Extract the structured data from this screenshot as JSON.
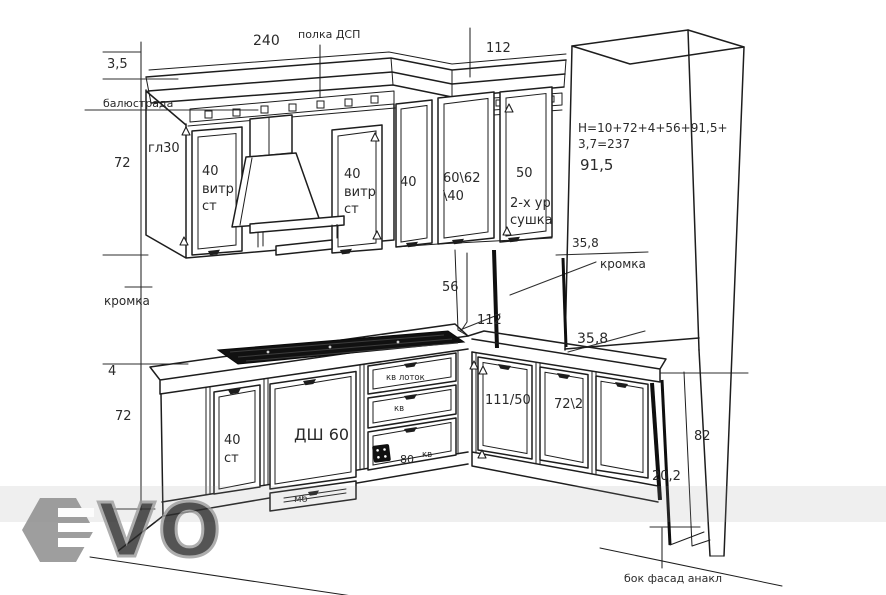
{
  "colors": {
    "ink": "#1d1d1d",
    "dim_ink": "#2e2e2e",
    "edge_dark": "#101010",
    "kromka_text": "#5c5c44",
    "blue_gray": "#44505c",
    "watermark_gray": "#8e8e8e"
  },
  "dims": {
    "total_width": "240",
    "top_depth": "112",
    "cornice_height": "3,5",
    "upper_height": "72",
    "backsplash_height": "56",
    "counter_corner_depth": "112",
    "counter_thickness": "4",
    "base_height": "72",
    "tall_upper_height": "91,5",
    "tall_top_offset": "35,8",
    "tall_bottom_offset": "35,8",
    "right_base_height": "82",
    "right_panel_depth": "20,2",
    "height_formula_line1": "Н=10+72+4+56+91,5+",
    "height_formula_line2": "3,7=237"
  },
  "notes": {
    "shelf": "полка ДСП",
    "balustrade": "балюстрада",
    "depth": "гл30",
    "edge_left": "кромка",
    "edge_right": "кромка",
    "side_facade": "бок фасад анакл"
  },
  "cabinets": {
    "upper_glass_left_line1": "40",
    "upper_glass_left_line2": "витр",
    "upper_glass_left_line3": "ст",
    "upper_glass_right_line1": "40",
    "upper_glass_right_line2": "витр",
    "upper_glass_right_line3": "ст",
    "upper_40": "40",
    "upper_corner_line1": "60\\62",
    "upper_corner_line2": "\\40",
    "upper_dryer_line1": "50",
    "upper_dryer_line2": "2-х ур",
    "upper_dryer_line3": "сушка",
    "base_glass_line1": "40",
    "base_glass_line2": "ст",
    "base_dishwasher": "ДШ 60",
    "base_plinth_drawer": "мб",
    "drawer_top": "кв лоток",
    "drawer_middle": "кв",
    "drawer_bottom_width": "80",
    "drawer_bottom_kv": "кв",
    "base_corner_right": "111/50",
    "base_right": "72\\2"
  },
  "watermark": {
    "letters": "VO"
  }
}
